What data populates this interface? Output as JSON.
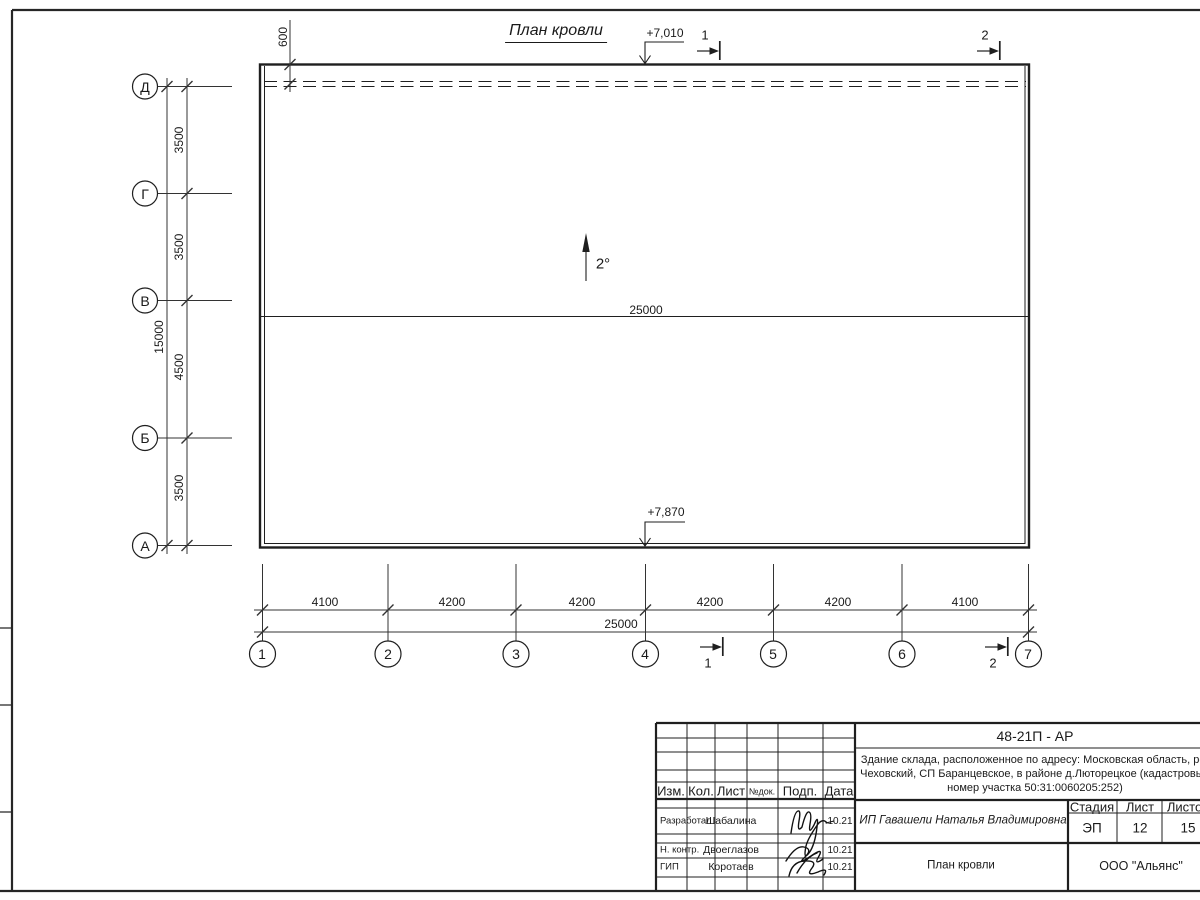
{
  "sheet": {
    "title": "План кровли",
    "slope_label": "2°",
    "elevation_top": "+7,010",
    "elevation_bottom": "+7,870",
    "offset_dim": "600",
    "ridge_dim": "25000",
    "section_1": "1",
    "section_2": "2",
    "axes_left": [
      "Д",
      "Г",
      "В",
      "Б",
      "А"
    ],
    "axes_bottom": [
      "1",
      "2",
      "3",
      "4",
      "5",
      "6",
      "7"
    ],
    "left_dims": [
      "3500",
      "3500",
      "4500",
      "3500"
    ],
    "left_total": "15000",
    "bottom_dims": [
      "4100",
      "4200",
      "4200",
      "4200",
      "4200",
      "4100"
    ],
    "bottom_total": "25000"
  },
  "titleblock": {
    "doc_code": "48-21П - АР",
    "object_line1": "Здание склада, расположенное по адресу: Московская область, р-н",
    "object_line2": "Чеховский, СП Баранцевское, в районе д.Люторецкое  (кадастровый",
    "object_line3": "номер участка 50:31:0060205:252)",
    "client": "ИП Гавашели Наталья Владимировна",
    "stage_label": "Стадия",
    "stage_value": "ЭП",
    "sheet_label": "Лист",
    "sheet_value": "12",
    "sheets_label": "Листов",
    "sheets_value": "15",
    "drawing_title": "План кровли",
    "company": "ООО \"Альянс\"",
    "cols": {
      "izm": "Изм.",
      "kol": "Кол.",
      "list": "Лист",
      "ndoc": "№док.",
      "podp": "Подп.",
      "data": "Дата"
    },
    "rows": [
      {
        "role": "Разработал",
        "name": "Шабалина",
        "date": "10.21"
      },
      {
        "role": "Н. контр.",
        "name": "Двоеглазов",
        "date": "10.21"
      },
      {
        "role": "ГИП",
        "name": "Коротаев",
        "date": "10.21"
      }
    ]
  }
}
